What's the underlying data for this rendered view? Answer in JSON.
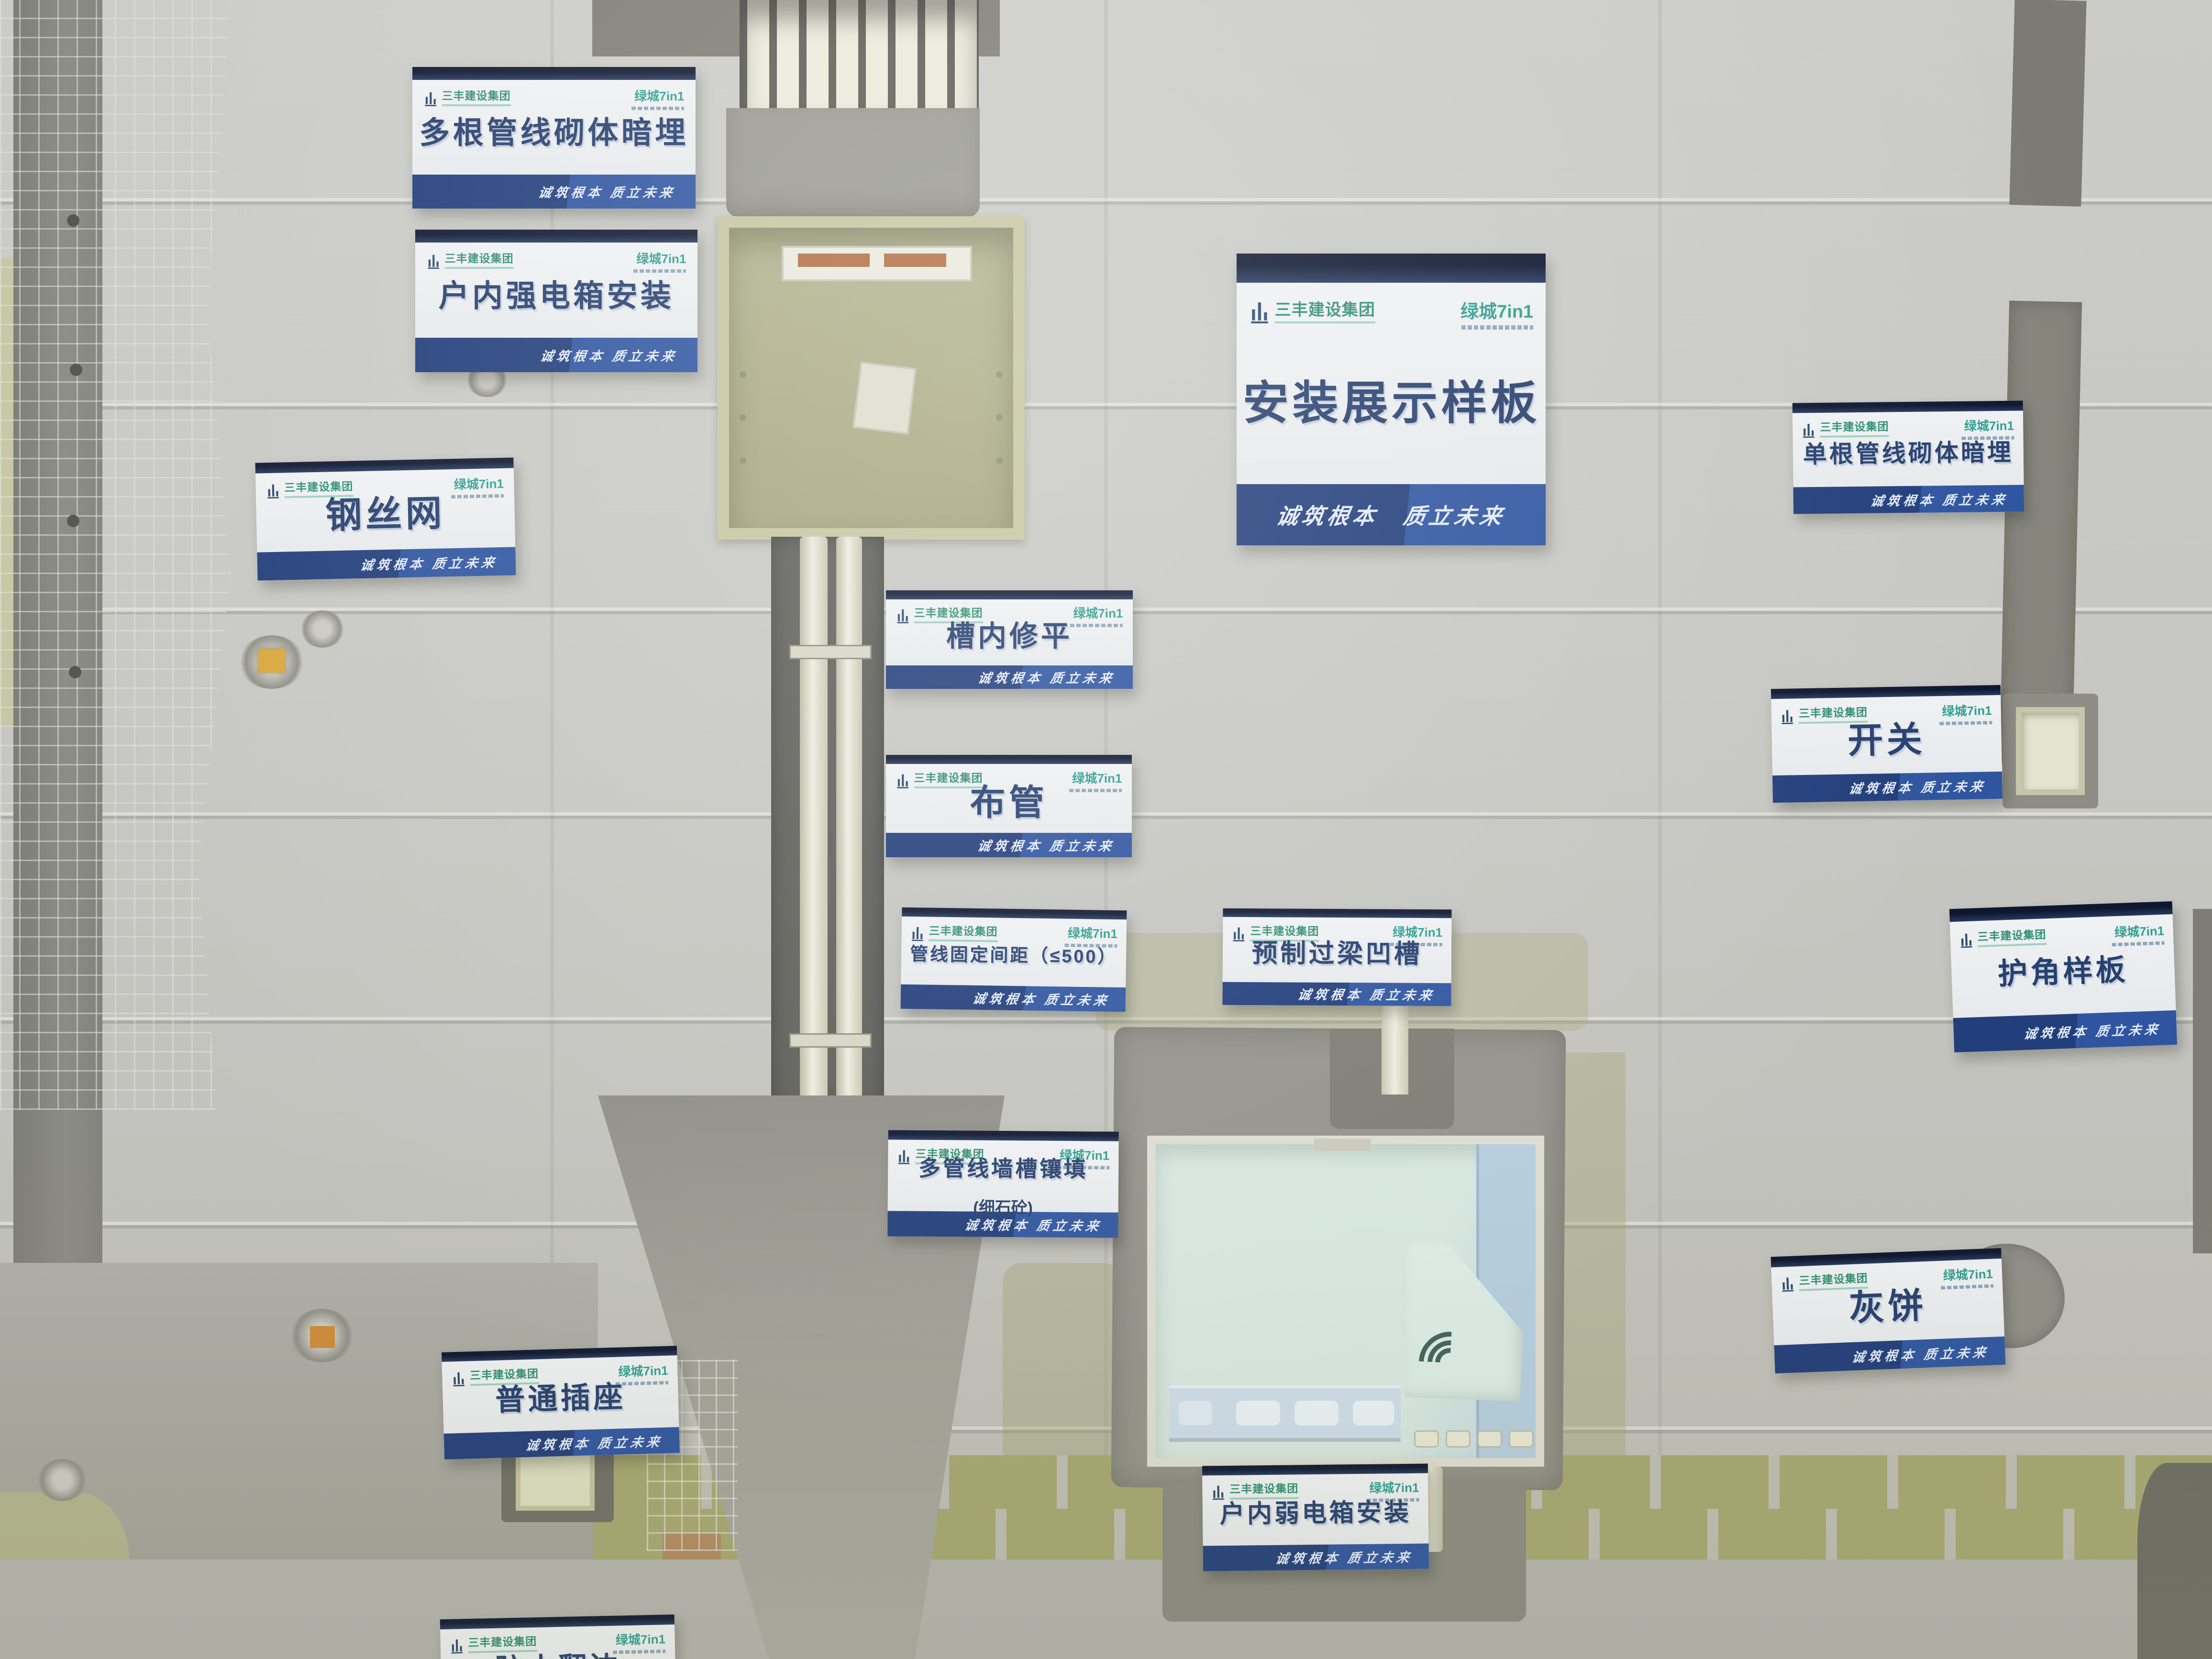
{
  "branding": {
    "company": "三丰建设集团",
    "partner": "绿城7in1",
    "slogan": "诚筑根本 质立未来"
  },
  "signs": {
    "multi_pipe_masonry": {
      "title": "多根管线砌体暗埋"
    },
    "indoor_strong_box": {
      "title": "户内强电箱安装"
    },
    "steel_wire_mesh": {
      "title": "钢丝网"
    },
    "main_board": {
      "title": "安装展示样板"
    },
    "single_pipe_masonry": {
      "title": "单根管线砌体暗埋"
    },
    "groove_leveling": {
      "title": "槽内修平"
    },
    "pipe_laying": {
      "title": "布管"
    },
    "pipe_fixing_spacing": {
      "title": "管线固定间距（≤500）"
    },
    "switch": {
      "title": "开关"
    },
    "corner_guard": {
      "title": "护角样板"
    },
    "precast_lintel_groove": {
      "title": "预制过梁凹槽"
    },
    "multi_pipe_wall_filling": {
      "title": "多管线墙槽镶填",
      "subtitle": "(细石砼)"
    },
    "mortar_pad": {
      "title": "灰饼"
    },
    "ordinary_socket": {
      "title": "普通插座"
    },
    "indoor_weak_box": {
      "title": "户内弱电箱安装"
    },
    "waterproof_flange": {
      "title": "防水翻边"
    }
  },
  "icons": {
    "company_logo": "building-bars-icon",
    "partner_logo": "tower-glyph-icon",
    "weak_box_logo": "wifi-arc-icon"
  },
  "colors": {
    "sign_top_navy": "#0e1730",
    "sign_strip_blue": "#2c4a8e",
    "title_blue": "#27406e",
    "brand_green": "#2e8f6e",
    "partner_teal": "#2f9e8f",
    "wall_gray": "#c6c6c2",
    "box_khaki": "#b3b390",
    "weak_box_mint": "#d7e8e1"
  }
}
